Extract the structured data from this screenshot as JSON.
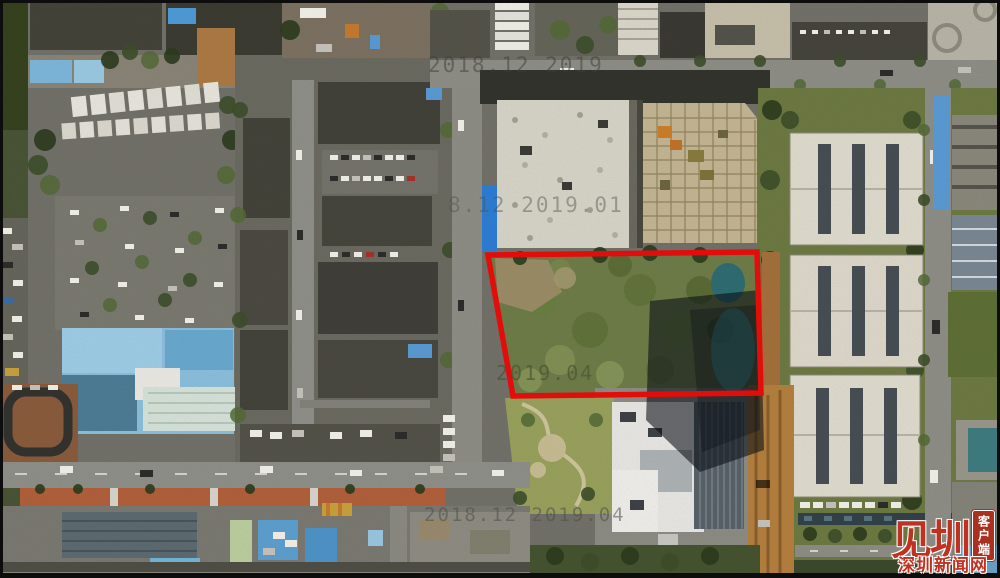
{
  "scene": {
    "kind": "aerial-satellite-photo",
    "annotation_outline_color": "#ea0e0c"
  },
  "watermarks": [
    {
      "id": "top",
      "text": "2018.12 2019"
    },
    {
      "id": "middle",
      "text": "8.12 2019.01"
    },
    {
      "id": "parcel",
      "text": "2019.04"
    },
    {
      "id": "bottom",
      "text": "2018.12 2019.04"
    }
  ],
  "logo": {
    "brand": "见圳",
    "seal_text": "客户端",
    "site": "深圳新闻网",
    "red": "#bf3222"
  }
}
